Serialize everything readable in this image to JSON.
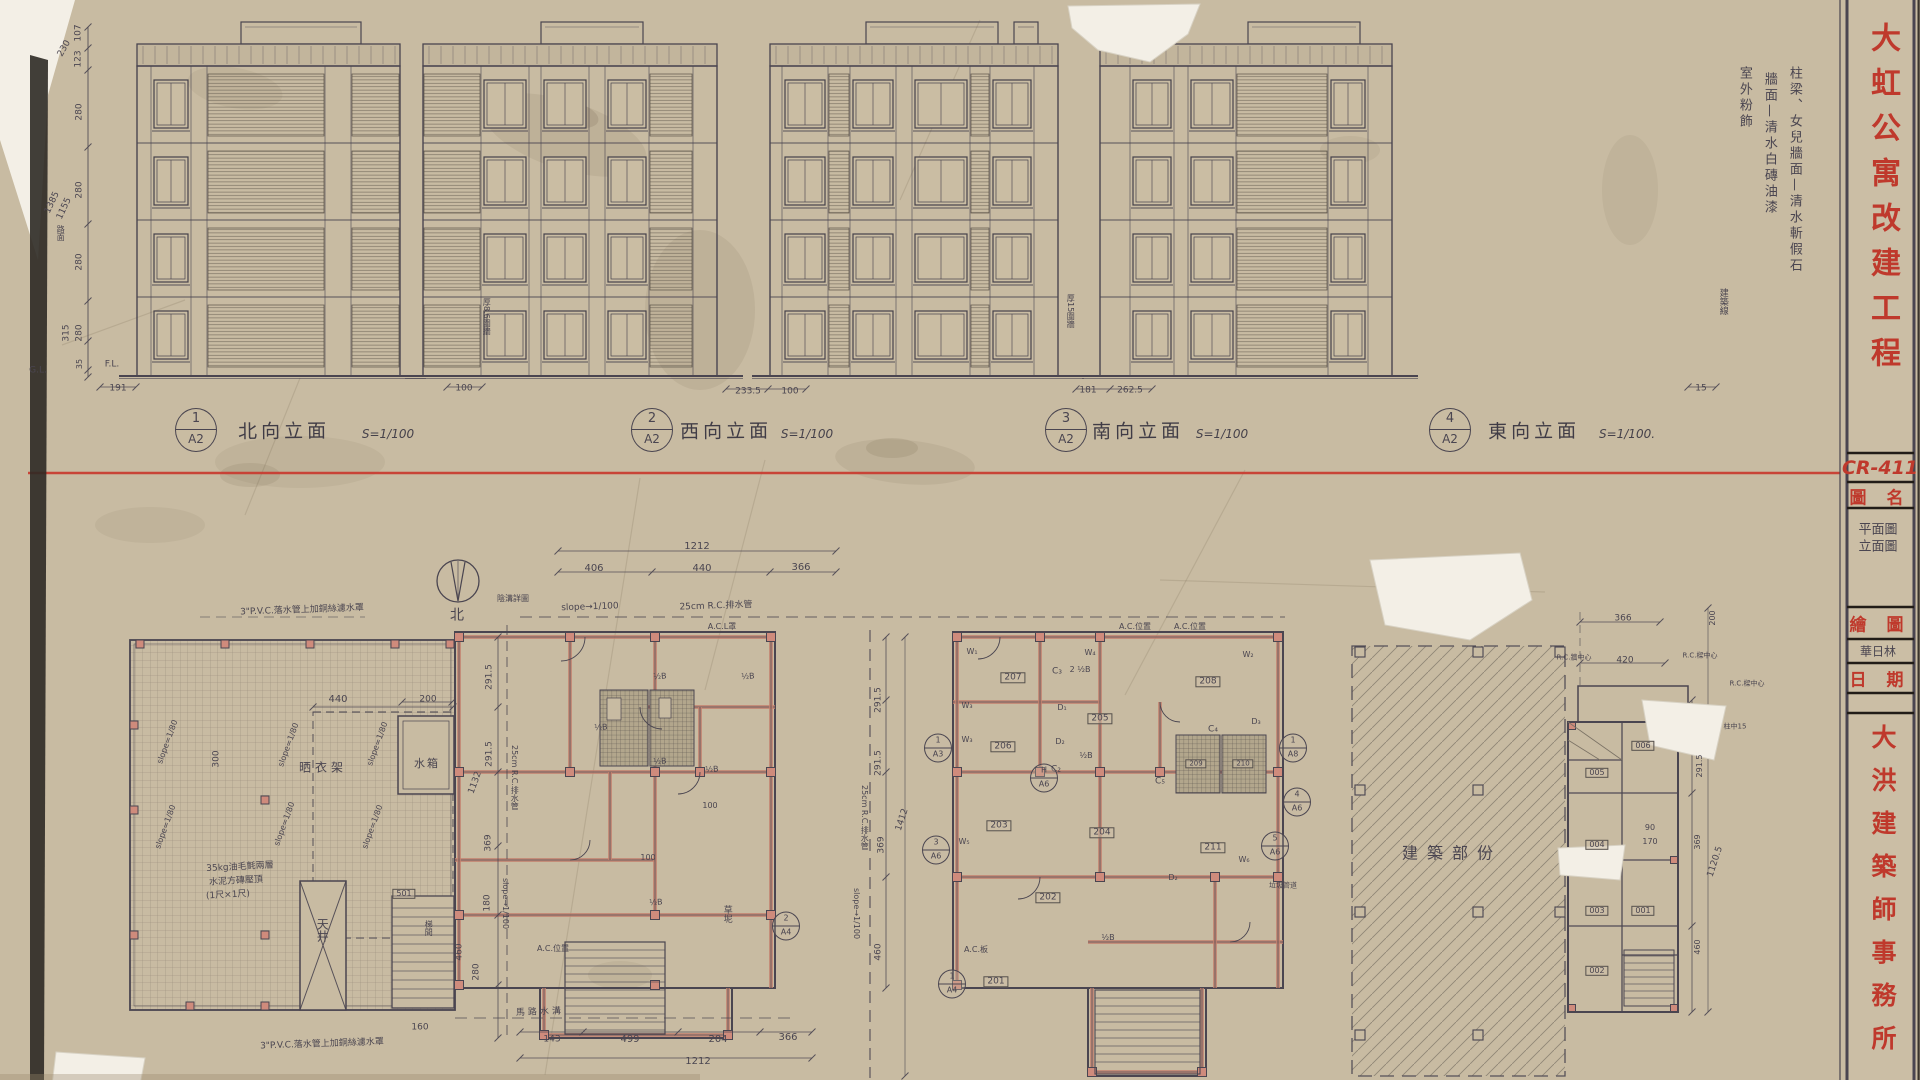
{
  "colors": {
    "paper": "#c8bba2",
    "pencil": "#4a4550",
    "red": "#bf392c",
    "red_line": "#c93a2f",
    "wall_pink": "#cf8b7c"
  },
  "title_block": {
    "project_title": "大虹公寓改建工程",
    "drawing_no": "CR-411",
    "name_label": "圖 名",
    "name_value_1": "平面圖",
    "name_value_2": "立面圖",
    "drafter_label": "繪 圖",
    "drafter_value": "華日林",
    "date_label": "日 期",
    "firm": "大洪建築師事務所"
  },
  "finish_note": [
    "柱梁、女兒牆面—清水斬假石",
    "牆面—清水白磚油漆",
    "室外粉飾"
  ],
  "elevations": [
    {
      "top": "1",
      "bot": "A2",
      "cx": 196,
      "name": "北向立面",
      "nx": 284,
      "scale": "S=1/100",
      "sx": 388,
      "y": 430
    },
    {
      "top": "2",
      "bot": "A2",
      "cx": 652,
      "name": "西向立面",
      "nx": 726,
      "scale": "S=1/100",
      "sx": 807,
      "y": 430
    },
    {
      "top": "3",
      "bot": "A2",
      "cx": 1066,
      "name": "南向立面",
      "nx": 1138,
      "scale": "S=1/100",
      "sx": 1222,
      "y": 430
    },
    {
      "top": "4",
      "bot": "A2",
      "cx": 1450,
      "name": "東向立面",
      "nx": 1534,
      "scale": "S=1/100.",
      "sx": 1627,
      "y": 430
    }
  ],
  "sections": [
    {
      "top": "1",
      "bot": "A3",
      "x": 938,
      "y": 748
    },
    {
      "top": "H",
      "bot": "A6",
      "x": 1044,
      "y": 778
    },
    {
      "top": "3",
      "bot": "A6",
      "x": 936,
      "y": 850
    },
    {
      "top": "4",
      "bot": "A6",
      "x": 1297,
      "y": 802
    },
    {
      "top": "5",
      "bot": "A6",
      "x": 1275,
      "y": 846
    },
    {
      "top": "1",
      "bot": "A4",
      "x": 952,
      "y": 984
    },
    {
      "top": "2",
      "bot": "A4",
      "x": 786,
      "y": 926
    },
    {
      "top": "1",
      "bot": "A8",
      "x": 1293,
      "y": 748
    }
  ],
  "annotations": [
    {
      "t": "107",
      "x": 79,
      "y": 33,
      "s": 9,
      "r": -90
    },
    {
      "t": "123",
      "x": 79,
      "y": 59,
      "s": 9,
      "r": -90
    },
    {
      "t": "230",
      "x": 65,
      "y": 49,
      "s": 9,
      "r": -60
    },
    {
      "t": "280",
      "x": 80,
      "y": 112,
      "s": 9,
      "r": -90
    },
    {
      "t": "280",
      "x": 80,
      "y": 190,
      "s": 9,
      "r": -90
    },
    {
      "t": "1385",
      "x": 53,
      "y": 203,
      "s": 9,
      "r": -65
    },
    {
      "t": "1155",
      "x": 65,
      "y": 209,
      "s": 9,
      "r": -65
    },
    {
      "t": "280",
      "x": 80,
      "y": 262,
      "s": 9,
      "r": -90
    },
    {
      "t": "315",
      "x": 67,
      "y": 333,
      "s": 9,
      "r": -90
    },
    {
      "t": "280",
      "x": 80,
      "y": 333,
      "s": 9,
      "r": -90
    },
    {
      "t": "35",
      "x": 80,
      "y": 364,
      "s": 8,
      "r": -90
    },
    {
      "t": "G.L.",
      "x": 38,
      "y": 371,
      "s": 9
    },
    {
      "t": "F.L.",
      "x": 112,
      "y": 365,
      "s": 9
    },
    {
      "t": "路面",
      "x": 60,
      "y": 225,
      "s": 8,
      "v": 1
    },
    {
      "t": "191",
      "x": 118,
      "y": 389,
      "s": 9
    },
    {
      "t": "100",
      "x": 464,
      "y": 389,
      "s": 9
    },
    {
      "t": "233.5",
      "x": 748,
      "y": 392,
      "s": 9
    },
    {
      "t": "100",
      "x": 790,
      "y": 392,
      "s": 9
    },
    {
      "t": "181",
      "x": 1088,
      "y": 391,
      "s": 9
    },
    {
      "t": "262.5",
      "x": 1130,
      "y": 391,
      "s": 9
    },
    {
      "t": "15",
      "x": 1701,
      "y": 389,
      "s": 9
    },
    {
      "t": "厚8.6圍牆",
      "x": 486,
      "y": 298,
      "s": 8,
      "v": 1
    },
    {
      "t": "厚15圍牆",
      "x": 1070,
      "y": 294,
      "s": 8,
      "v": 1
    },
    {
      "t": "建築線",
      "x": 1722,
      "y": 288,
      "s": 9,
      "v": 1
    },
    {
      "t": "3\"P.V.C.落水管上加銅絲濾水罩",
      "x": 302,
      "y": 611,
      "s": 9,
      "r": -2
    },
    {
      "t": "3\"P.V.C.落水管上加銅絲濾水罩",
      "x": 322,
      "y": 1045,
      "s": 9,
      "r": -2
    },
    {
      "t": "slope=1/80",
      "x": 168,
      "y": 742,
      "s": 8,
      "r": -70
    },
    {
      "t": "slope=1/80",
      "x": 289,
      "y": 745,
      "s": 8,
      "r": -70
    },
    {
      "t": "slope=1/80",
      "x": 378,
      "y": 744,
      "s": 8,
      "r": -70
    },
    {
      "t": "slope=1/80",
      "x": 166,
      "y": 827,
      "s": 8,
      "r": -70
    },
    {
      "t": "slope=1/80",
      "x": 285,
      "y": 824,
      "s": 8,
      "r": -70
    },
    {
      "t": "slope=1/80",
      "x": 373,
      "y": 827,
      "s": 8,
      "r": -70
    },
    {
      "t": "440",
      "x": 338,
      "y": 700,
      "s": 10
    },
    {
      "t": "200",
      "x": 428,
      "y": 700,
      "s": 9
    },
    {
      "t": "300",
      "x": 217,
      "y": 759,
      "s": 9,
      "r": -90
    },
    {
      "t": "晒衣架",
      "x": 323,
      "y": 768,
      "s": 12,
      "w": 4
    },
    {
      "t": "水箱",
      "x": 427,
      "y": 764,
      "s": 11,
      "w": 2
    },
    {
      "t": "天井",
      "x": 322,
      "y": 918,
      "s": 12,
      "v": 1
    },
    {
      "t": "35kg油毛氈兩層",
      "x": 240,
      "y": 868,
      "s": 9,
      "r": -3
    },
    {
      "t": "水泥方磚壓頂",
      "x": 236,
      "y": 882,
      "s": 9,
      "r": -3
    },
    {
      "t": "(1尺×1尺)",
      "x": 228,
      "y": 896,
      "s": 9,
      "r": -3
    },
    {
      "t": "501",
      "x": 404,
      "y": 894,
      "s": 8,
      "b": 1
    },
    {
      "t": "梯間",
      "x": 428,
      "y": 920,
      "s": 8,
      "v": 1
    },
    {
      "t": "160",
      "x": 420,
      "y": 1028,
      "s": 9
    },
    {
      "t": "北",
      "x": 457,
      "y": 616,
      "s": 14
    },
    {
      "t": "1212",
      "x": 697,
      "y": 547,
      "s": 10
    },
    {
      "t": "406",
      "x": 594,
      "y": 569,
      "s": 10
    },
    {
      "t": "440",
      "x": 702,
      "y": 569,
      "s": 10
    },
    {
      "t": "366",
      "x": 801,
      "y": 568,
      "s": 10
    },
    {
      "t": "slope→1/100",
      "x": 590,
      "y": 608,
      "s": 9,
      "r": -2
    },
    {
      "t": "25cm R.C.排水管",
      "x": 716,
      "y": 607,
      "s": 9,
      "r": -2
    },
    {
      "t": "A.C.L罩",
      "x": 722,
      "y": 627,
      "s": 8
    },
    {
      "t": "陰溝詳圖",
      "x": 513,
      "y": 599,
      "s": 8
    },
    {
      "t": "291.5",
      "x": 490,
      "y": 677,
      "s": 9,
      "r": -90
    },
    {
      "t": "291.5",
      "x": 490,
      "y": 754,
      "s": 9,
      "r": -90
    },
    {
      "t": "1132",
      "x": 476,
      "y": 783,
      "s": 9,
      "r": -70
    },
    {
      "t": "369",
      "x": 489,
      "y": 843,
      "s": 9,
      "r": -90
    },
    {
      "t": "180",
      "x": 488,
      "y": 903,
      "s": 9,
      "r": -90
    },
    {
      "t": "460",
      "x": 460,
      "y": 952,
      "s": 9,
      "r": -90
    },
    {
      "t": "280",
      "x": 477,
      "y": 972,
      "s": 9,
      "r": -90
    },
    {
      "t": "25cm R.C.排水管",
      "x": 514,
      "y": 745,
      "s": 8,
      "v": 1
    },
    {
      "t": "slope→1/100",
      "x": 505,
      "y": 878,
      "s": 8,
      "v": 1
    },
    {
      "t": "½B",
      "x": 660,
      "y": 677,
      "s": 8,
      "r": -4
    },
    {
      "t": "½B",
      "x": 748,
      "y": 677,
      "s": 8,
      "r": -4
    },
    {
      "t": "½B",
      "x": 601,
      "y": 728,
      "s": 8,
      "r": -4
    },
    {
      "t": "½B",
      "x": 660,
      "y": 762,
      "s": 8,
      "r": -4
    },
    {
      "t": "½B",
      "x": 712,
      "y": 770,
      "s": 8,
      "r": -4
    },
    {
      "t": "½B",
      "x": 656,
      "y": 903,
      "s": 8,
      "r": -4
    },
    {
      "t": "100",
      "x": 710,
      "y": 806,
      "s": 8
    },
    {
      "t": "100",
      "x": 648,
      "y": 858,
      "s": 8
    },
    {
      "t": "A.C.位置",
      "x": 553,
      "y": 949,
      "s": 8
    },
    {
      "t": "草坭",
      "x": 726,
      "y": 905,
      "s": 9,
      "v": 1
    },
    {
      "t": "馬路水溝",
      "x": 540,
      "y": 1013,
      "s": 9,
      "r": -2,
      "w": 3
    },
    {
      "t": "143",
      "x": 552,
      "y": 1040,
      "s": 9
    },
    {
      "t": "499",
      "x": 630,
      "y": 1040,
      "s": 10
    },
    {
      "t": "204",
      "x": 718,
      "y": 1040,
      "s": 10
    },
    {
      "t": "366",
      "x": 788,
      "y": 1038,
      "s": 10
    },
    {
      "t": "1212",
      "x": 698,
      "y": 1062,
      "s": 10
    },
    {
      "t": "207",
      "x": 1013,
      "y": 678,
      "s": 9,
      "b": 1
    },
    {
      "t": "206",
      "x": 1003,
      "y": 747,
      "s": 9,
      "b": 1
    },
    {
      "t": "205",
      "x": 1100,
      "y": 719,
      "s": 9,
      "b": 1
    },
    {
      "t": "208",
      "x": 1208,
      "y": 682,
      "s": 9,
      "b": 1
    },
    {
      "t": "203",
      "x": 999,
      "y": 826,
      "s": 9,
      "b": 1
    },
    {
      "t": "204",
      "x": 1102,
      "y": 833,
      "s": 9,
      "b": 1
    },
    {
      "t": "202",
      "x": 1048,
      "y": 898,
      "s": 9,
      "b": 1
    },
    {
      "t": "201",
      "x": 996,
      "y": 982,
      "s": 9,
      "b": 1
    },
    {
      "t": "209",
      "x": 1196,
      "y": 764,
      "s": 7,
      "b": 1
    },
    {
      "t": "210",
      "x": 1243,
      "y": 764,
      "s": 7,
      "b": 1
    },
    {
      "t": "211",
      "x": 1213,
      "y": 848,
      "s": 9,
      "b": 1
    },
    {
      "t": "W₁",
      "x": 972,
      "y": 652,
      "s": 8
    },
    {
      "t": "W₂",
      "x": 1248,
      "y": 655,
      "s": 8
    },
    {
      "t": "W₃",
      "x": 967,
      "y": 706,
      "s": 8
    },
    {
      "t": "W₃",
      "x": 967,
      "y": 740,
      "s": 8
    },
    {
      "t": "W₄",
      "x": 1090,
      "y": 653,
      "s": 8
    },
    {
      "t": "W₅",
      "x": 964,
      "y": 842,
      "s": 8
    },
    {
      "t": "W₆",
      "x": 1244,
      "y": 860,
      "s": 8
    },
    {
      "t": "C₂",
      "x": 1056,
      "y": 770,
      "s": 9
    },
    {
      "t": "C₃",
      "x": 1057,
      "y": 672,
      "s": 9
    },
    {
      "t": "C₄",
      "x": 1213,
      "y": 730,
      "s": 9
    },
    {
      "t": "C₅",
      "x": 1160,
      "y": 782,
      "s": 9
    },
    {
      "t": "D₁",
      "x": 1062,
      "y": 708,
      "s": 8
    },
    {
      "t": "D₂",
      "x": 1060,
      "y": 742,
      "s": 8
    },
    {
      "t": "D₃",
      "x": 1256,
      "y": 722,
      "s": 8
    },
    {
      "t": "D₂",
      "x": 1173,
      "y": 878,
      "s": 8
    },
    {
      "t": "2 ½B",
      "x": 1080,
      "y": 670,
      "s": 8
    },
    {
      "t": "½B",
      "x": 1086,
      "y": 756,
      "s": 8
    },
    {
      "t": "½B",
      "x": 1108,
      "y": 938,
      "s": 8
    },
    {
      "t": "291.5",
      "x": 879,
      "y": 700,
      "s": 9,
      "r": -90
    },
    {
      "t": "291.5",
      "x": 879,
      "y": 763,
      "s": 9,
      "r": -90
    },
    {
      "t": "369",
      "x": 882,
      "y": 845,
      "s": 9,
      "r": -90
    },
    {
      "t": "460",
      "x": 879,
      "y": 952,
      "s": 9,
      "r": -90
    },
    {
      "t": "1412",
      "x": 903,
      "y": 820,
      "s": 9,
      "r": -72
    },
    {
      "t": "A.C.位置",
      "x": 1135,
      "y": 627,
      "s": 8
    },
    {
      "t": "A.C.位置",
      "x": 1190,
      "y": 627,
      "s": 8
    },
    {
      "t": "25cm R.C.排水管",
      "x": 864,
      "y": 785,
      "s": 8,
      "v": 1
    },
    {
      "t": "slope→1/100",
      "x": 856,
      "y": 888,
      "s": 8,
      "v": 1
    },
    {
      "t": "垃圾管道",
      "x": 1283,
      "y": 886,
      "s": 7
    },
    {
      "t": "A.C.板",
      "x": 976,
      "y": 950,
      "s": 8
    },
    {
      "t": "建築部份",
      "x": 1452,
      "y": 854,
      "s": 16,
      "w": 9
    },
    {
      "t": "366",
      "x": 1623,
      "y": 619,
      "s": 9
    },
    {
      "t": "420",
      "x": 1625,
      "y": 661,
      "s": 9
    },
    {
      "t": "200",
      "x": 1713,
      "y": 618,
      "s": 8,
      "r": -90
    },
    {
      "t": "291.5",
      "x": 1700,
      "y": 766,
      "s": 8,
      "r": -90
    },
    {
      "t": "369",
      "x": 1698,
      "y": 842,
      "s": 8,
      "r": -90
    },
    {
      "t": "1120.5",
      "x": 1716,
      "y": 862,
      "s": 9,
      "r": -72
    },
    {
      "t": "460",
      "x": 1698,
      "y": 947,
      "s": 8,
      "r": -90
    },
    {
      "t": "90",
      "x": 1650,
      "y": 828,
      "s": 8
    },
    {
      "t": "170",
      "x": 1650,
      "y": 842,
      "s": 8
    },
    {
      "t": "R.C.牆中心",
      "x": 1574,
      "y": 658,
      "s": 7
    },
    {
      "t": "R.C.樑中心",
      "x": 1700,
      "y": 656,
      "s": 7
    },
    {
      "t": "R.C.樑中心",
      "x": 1747,
      "y": 684,
      "s": 7
    },
    {
      "t": "柱中15",
      "x": 1735,
      "y": 727,
      "s": 7
    },
    {
      "t": "006",
      "x": 1643,
      "y": 746,
      "s": 8,
      "b": 1
    },
    {
      "t": "005",
      "x": 1597,
      "y": 773,
      "s": 8,
      "b": 1
    },
    {
      "t": "004",
      "x": 1597,
      "y": 845,
      "s": 8,
      "b": 1
    },
    {
      "t": "003",
      "x": 1597,
      "y": 911,
      "s": 8,
      "b": 1
    },
    {
      "t": "001",
      "x": 1643,
      "y": 911,
      "s": 8,
      "b": 1
    },
    {
      "t": "002",
      "x": 1597,
      "y": 971,
      "s": 8,
      "b": 1
    }
  ]
}
